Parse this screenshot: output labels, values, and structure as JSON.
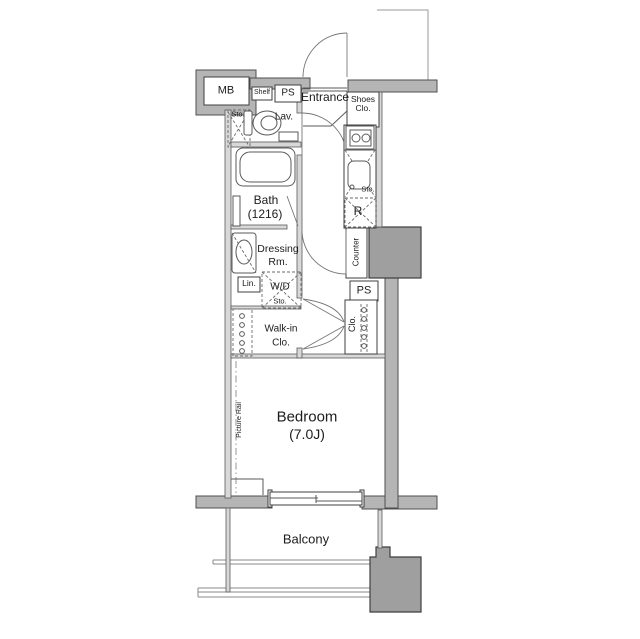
{
  "plan_title": "1K apartment floor plan",
  "colors": {
    "wall": "#b5b5b5",
    "pillar": "#9f9f9f",
    "thin_wall": "#d8d8d8",
    "outline": "#4f4f4f",
    "text": "#1c1c1c",
    "background": "#ffffff"
  },
  "labels": {
    "mb": "MB",
    "shelf": "Shelf",
    "ps_top": "PS",
    "entrance": "Entrance",
    "shoes": {
      "l1": "Shoes",
      "l2": "Clo."
    },
    "sto_toilet": "Sto.",
    "lav": "Lav.",
    "bath": {
      "l1": "Bath",
      "l2": "(1216)"
    },
    "sto_kitchen": "Sto.",
    "refrigerator": "R",
    "counter": "Counter",
    "ps_mid": "PS",
    "clo": "Clo.",
    "dressing": {
      "l1": "Dressing",
      "l2": "Rm."
    },
    "lin": "Lin.",
    "wd": "W/D",
    "sto_wd": "Sto.",
    "walk_in": {
      "l1": "Walk-in",
      "l2": "Clo."
    },
    "picture_rail": "Picture Rail",
    "bedroom": {
      "l1": "Bedroom",
      "l2": "(7.0J)"
    },
    "balcony": "Balcony"
  }
}
